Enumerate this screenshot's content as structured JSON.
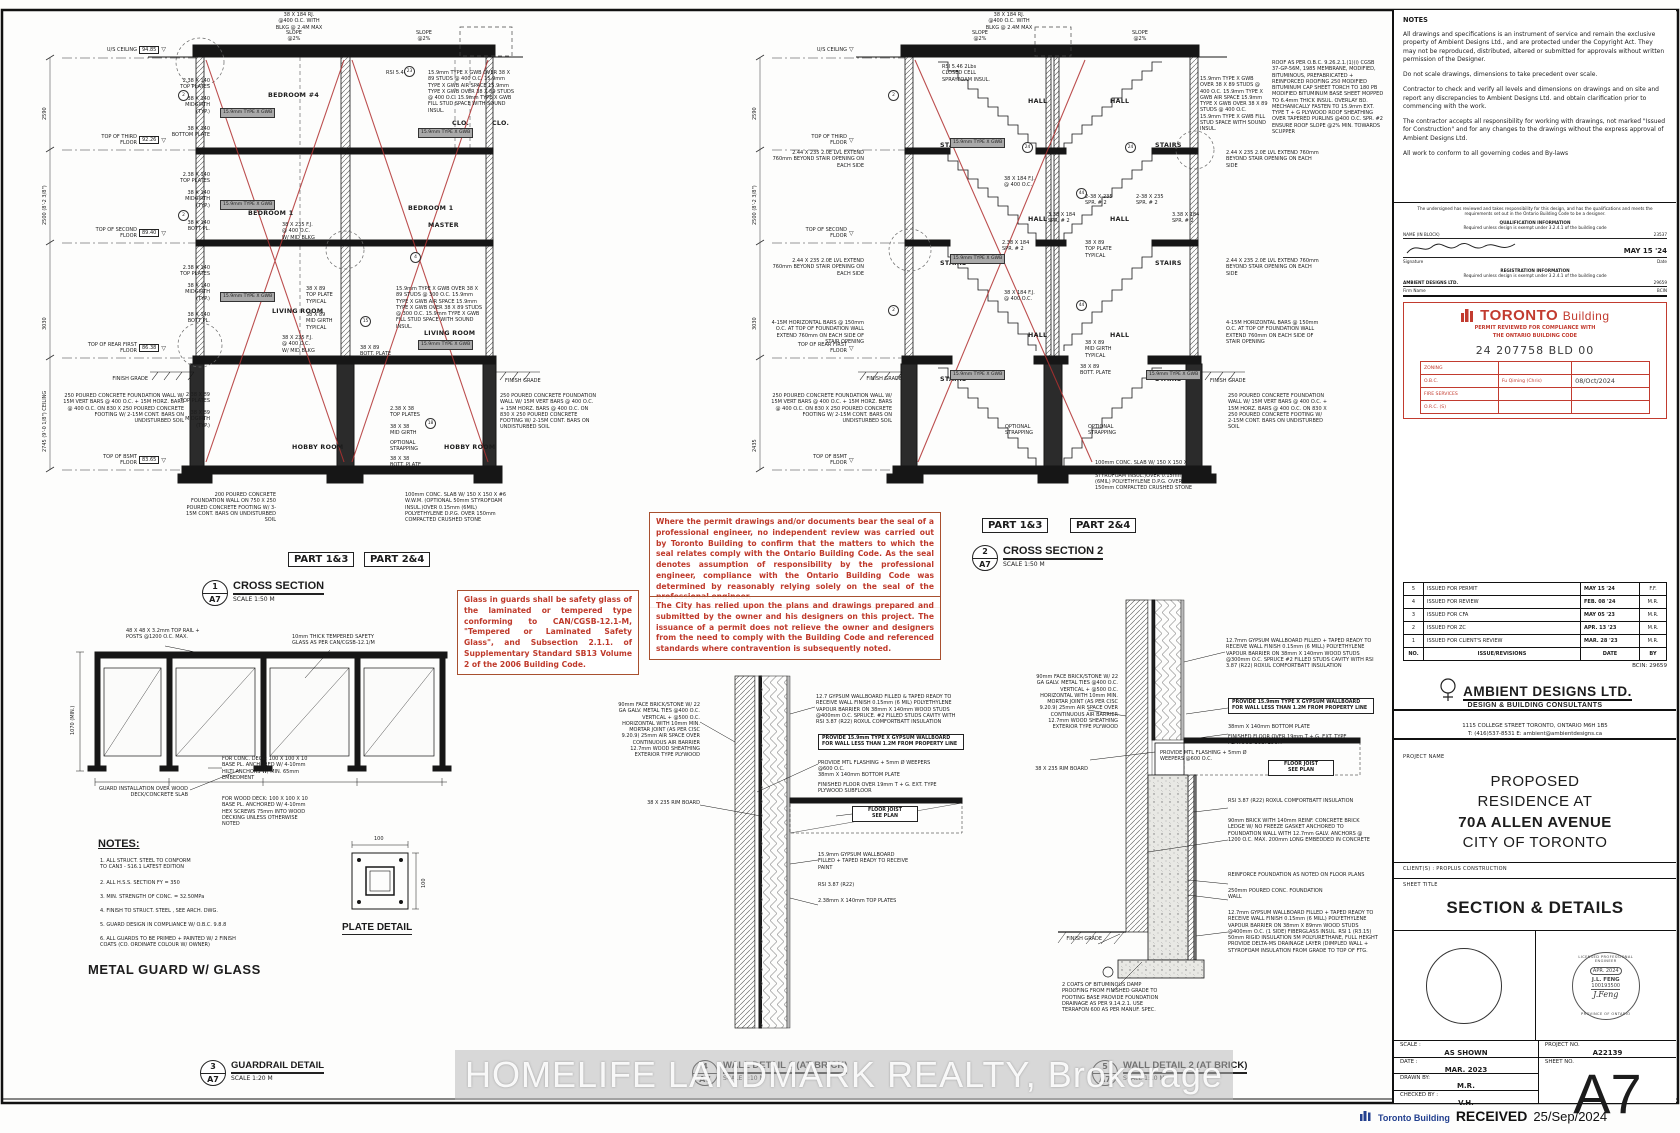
{
  "watermark": "HOMELIFE LANDMARK REALTY, Brokerage",
  "received": {
    "agency": "Toronto Building",
    "label": "RECEIVED",
    "date": "25/Sep/2024"
  },
  "labels": {
    "d1": {
      "num": "1",
      "ref": "A7",
      "title": "CROSS SECTION",
      "scale": "SCALE 1:50 M"
    },
    "d2": {
      "num": "2",
      "ref": "A7",
      "title": "CROSS SECTION 2",
      "scale": "SCALE 1:50 M"
    },
    "d3": {
      "num": "3",
      "ref": "A7",
      "title": "GUARDRAIL DETAIL",
      "scale": "SCALE 1:20 M"
    },
    "d4": {
      "num": "4",
      "ref": "A7",
      "title": "WALL DETAIL 1 (AT BRICK)",
      "scale": "SCALE 1:10 M"
    },
    "d5": {
      "num": "5",
      "ref": "A7",
      "title": "WALL DETAIL 2 (AT BRICK)",
      "scale": "SCALE 1:10 M"
    },
    "part13": "PART 1&3",
    "part24": "PART 2&4"
  },
  "levels": [
    {
      "name": "U/S CEILING",
      "elev": "94.85",
      "tri": "▽"
    },
    {
      "name": "TOP OF THIRD FLOOR",
      "elev": "92.26",
      "tri": "▽"
    },
    {
      "name": "TOP OF SECOND FLOOR",
      "elev": "89.40",
      "tri": "▽"
    },
    {
      "name": "TOP OF REAR FIRST FLOOR",
      "elev": "86.38",
      "tri": "▽"
    },
    {
      "name": "TOP OF BSMT FLOOR",
      "elev": "83.65",
      "tri": "▽"
    }
  ],
  "dims": [
    "2590",
    "2500 (8'-2 3/8\")",
    "3030",
    "2745 (9'-0 1/8\") CEILING",
    "2435"
  ],
  "callouts": [
    "2",
    "4",
    "15",
    "18",
    "23",
    "24",
    "44",
    "46",
    "48",
    "2",
    "24",
    "44"
  ],
  "rooms": {
    "bedroom4": "BEDROOM #4",
    "clo": "CLO.",
    "bedroom1": "BEDROOM 1",
    "master": "MASTER",
    "living": "LIVING ROOM",
    "hobby": "HOBBY ROOM",
    "hall": "HALL",
    "stairs": "STAIRS"
  },
  "ann": {
    "gwb": "15.9mm TYPE X GWB",
    "slope": "SLOPE\n@2%",
    "rj": "38 X 184 RJ.\n@400 O.C. WITH\nBLKG @ 2.4M MAX",
    "rsi546": "RSI 5.46",
    "sprayfoam": "RSI 5.46 2Lbs\nCLOSED CELL\nSPRAYFOAM INSUL.",
    "roof": "ROOF AS PER O.B.C. 9.26.2.1.(1)(i) CGSB 37-GP-56M, 1985 MEMBRANE, MODIFIED, BITUMINOUS, PREFABRICATED + REINFORCED ROOFING 250 MODIFIED BITUMINUM CAP SHEET TORCH TO 180 PB MODIFIED BITUMINUM BASE SHEET MOPPED TO 6.4mm THICK INSUL. OVERLAY BD. MECHANICALLY FASTEN TO 15.9mm EXT. TYPE T + G PLYWOOD ROOF SHEATHING OVER TAPERED PURLINS @400 O.C. SPR. #2 ENSURE ROOF SLOPE @2% MIN. TOWARDS SCUPPER",
    "demising400": "15.9mm TYPE X GWB OVER 38 X 89 STUDS @ 400 O.C. 15.9mm TYPE X GWB AIR SPACE 15.9mm TYPE X GWB OVER 38 X 89 STUDS @ 400 O.C. 15.9mm TYPE X GWB FILL STUD SPACE WITH SOUND INSUL.",
    "demising300": "15.9mm TYPE X GWB OVER 38 X 89 STUDS @ 300 O.C. 15.9mm TYPE X GWB AIR SPACE 15.9mm TYPE X GWB OVER 38 X 89 STUDS @ 300 O.C. 15.9mm TYPE X GWB FILL STUD SPACE WITH SOUND INSUL.",
    "tp140": "2.38 X 140\nTOP PLATES",
    "mid140": "38 X 140\nMIDGIRTH\n(TYP.)",
    "botpl140": "38 X 140\nBOTTOM PLATE",
    "botpl140s": "38 X 140\nBOTT PL.",
    "fj235": "38 X 235 F.J.\n@ 400 O.C.\nW/ MID BLKG",
    "tp89": "2.38 X 89\nTOP PLATES",
    "mid89": "38 X 89\nMIDGIRTH\n(TYP.)",
    "tp38": "2.38 X 38\nTOP PLATES",
    "mg38": "38 X 38\nMID GIRTH",
    "optstrap": "OPTIONAL\nSTRAPPING",
    "bp38": "38 X 38\nBOTT. PLATE",
    "tpTyp": "38 X 89\nTOP PLATE\nTYPICAL",
    "mgTyp": "38 X 89\nMID GIRTH\nTYPICAL",
    "bp89": "38 X 89\nBOTT. PLATE",
    "lvl": "2.44 X 235 2.0E LVL EXTEND 760mm BEYOND STAIR OPENING ON EACH SIDE",
    "fj184": "38 X 184 F.J.\n@ 400 O.C.",
    "spr235": "2-38 X 235\nSPR. # 2",
    "spr184a": "3.38 X 184\nSPR. # 2",
    "spr184b": "2.38 X 184\nSPR. # 2",
    "horizbars": "4-15M HORIZONTAL BARS @ 150mm O.C. AT TOP OF FOUNDATION WALL EXTEND 760mm ON EACH SIDE OF STAIR OPENING",
    "found250": "250 POURED CONCRETE FOUNDATION WALL W/ 15M VERT BARS @ 400 O.C. + 15M HORZ. BARS @ 400 O.C. ON 830 X 250 POURED CONCRETE FOOTING W/ 2-15M CONT. BARS ON UNDISTURBED SOIL",
    "found200": "200 POURED CONCRETE FOUNDATION WALL ON 750 X 250 POURED CONCRETE FOOTING W/ 3-15M CONT. BARS ON UNDISTURBED SOIL",
    "slab": "100mm CONC. SLAB W/ 150 X 150 X #6 W.W.M. (OPTIONAL 50mm STYROFOAM INSUL.)OVER 0.15mm (6MIL) POLYETHYLENE D.P.G. OVER 150mm COMPACTED CRUSHED STONE",
    "grade": "FINISH GRADE"
  },
  "red_notes": {
    "glass": "Glass in guards shall be safety glass of the laminated or tempered type conforming to CAN/CGSB-12.1-M, \"Tempered or Laminated Safety Glass\", and Subsection 2.1.1. of Supplementary Standard SB13 Volume 2 of the 2006 Building Code.",
    "seal": "Where the permit drawings and/or documents bear the seal of a professional engineer, no independent review was carried out by Toronto Building to confirm that the matters to which the seal relates comply with the Ontario Building Code. As the seal denotes assumption of responsibility by the professional engineer, compliance with the Ontario Building Code was determined by reasonably relying solely on the seal of the professional engineer.",
    "city": "The City has relied upon the plans and drawings prepared and submitted by the owner and his designers on this project. The issuance of a permit does not relieve the owner and designers from the need to comply with the Building Code and referenced standards where contravention is subsequently noted."
  },
  "guard": {
    "toprail": "48 X 48 X 3.2mm TOP RAIL + POSTS @1200 O.C. MAX.",
    "glass": "10mm THICK TEMPERED SAFETY GLASS AS PER CAN/CGSB-12.1/M",
    "install": "GUARD INSTALLATION OVER WOOD DECK/CONCRETE SLAB",
    "concdeck": "FOR CONC. DECK: 100 X 100 X 10 BASE PL. ANCHORED W/ 4-10mm HILTI ANCHORS W/ MIN. 65mm EMBEDMENT",
    "wooddeck": "FOR WOOD DECK: 100 X 100 X 10 BASE PL. ANCHORED W/ 4-10mm HEX SCREWS 75mm INTO WOOD DECKING UNLESS OTHERWISE NOTED",
    "height": "1070 (MIN.)",
    "heading": "METAL GUARD W/ GLASS",
    "plate_label": "PLATE DETAIL",
    "plate_dim": "100",
    "notes_title": "NOTES:",
    "notes": [
      "1.   ALL STRUCT. STEEL TO CONFORM\n      TO CAN3 - S16.1 LATEST EDITION",
      "2.   ALL H.S.S. SECTION FY = 350",
      "3.   MIN. STRENGTH OF CONC. = 32.50MPa",
      "4.   FINISH TO STRUCT. STEEL , SEE ARCH. DWG.",
      "5.   GUARD DESIGN IN COMPLIANCE W/ O.B.C. 9.8.8",
      "6.   ALL GUARDS TO BE PRIMED + PAINTED W/ 2 FINISH\n      COATS (CO. ORDINATE COLOUR W/ OWNER)"
    ]
  },
  "d45": {
    "brick90": "90mm FACE BRICK/STONE W/ 22 GA GALV. METAL TIES @400 O.C. VERTICAL + @500 O.C. HORIZONTAL WITH 10mm MIN. MORTAR JOINT (AS PER CISC 9.20.9) 25mm AIR SPACE OVER CONTINUOUS AIR BARRIER 12.7mm WOOD SHEATHING EXTERIOR TYPE PLYWOOD",
    "gyp140": "12.7 GYPSUM WALLBOARD FILLED & TAPED READY TO RECEIVE WALL FINISH 0.15mm (6 MIL) POLYETHYLENE VAPOUR BARRIER ON 38mm X 140mm WOOD STUDS @400mm O.C. SPRUCE. #2 FILLED STUDS CAVITY WITH RSI 3.87 (R22) ROXUL COMFORTBATT INSULATION",
    "gyp89": "12.7mm GYPSUM WALLBOARD FILLED + TAPED READY TO RECEIVE WALL FINISH 0.15mm (6 MILL) POLYETHYLENE VAPOUR BARRIER ON 38mm X 140mm WOOD STUDS @300mm O.C. SPRUCE #2 FILLED STUDS CAVITY WITH RSI 3.87 (R22) ROXUL COMFORTBATT INSULATION",
    "provide": "PROVIDE 15.9mm TYPE X GYPSUM WALLBOARD FOR WALL LESS THAN 1.2M FROM PROPERTY LINE",
    "bottomplate": "38mm X 140mm BOTTOM PLATE",
    "topplates": "2.38mm X 140mm TOP PLATES",
    "finfloor": "FINISHED FLOOR OVER 19mm T + G. EXT. TYPE PLYWOOD SUBFLOOR",
    "floorjoist": "FLOOR JOIST\nSEE PLAN",
    "rim": "38 X 235 RIM BOARD",
    "flashing": "PROVIDE MTL FLASHING + 5mm Ø WEEPERS @600 O.C.",
    "gwbpaint": "15.9mm GYPSUM WALLBOARD FILLED + TAPED READY TO RECEIVE PAINT",
    "rsi": "RSI 3.87 (R22)",
    "rsiroxul": "RSI 3.87 (R22) ROXUL COMFORTBATT INSULATION",
    "brickledge": "90mm BRICK WITH 140mm REINF. CONCRETE BRICK LEDGE W/ NO FREEZE GASKET ANCHORED TO FOUNDATION WALL WITH 12.7mm GALV. ANCHORS @ 1200 O.C. MAX. 200mm LONG EMBEDDED IN CONCRETE",
    "reinforce": "REINFORCE FOUNDATION AS NOTED ON FLOOR PLANS",
    "foundwall": "250mm POURED CONC. FOUNDATION WALL",
    "bsmtwall": "12.7mm GYPSUM WALLBOARD FILLED + TAPED READY TO RECEIVE WALL FINISH 0.15mm (6 MILL) POLYETHYLENE VAPOUR BARRIER ON 38mm X 89mm WOOD STUDS @400mm O.C. (1 SIDE) FIBERGLASS INSUL. RSI 1 (R3.15) 50mm RIGID INSULATION 5M POLYURETHANE, FULL HEIGHT PROVIDE DELTA-MS DRAINAGE LAYER (DIMPLED WALL + STYROFOAM INSULATION FROM GRADE TO TOP OF FTG.",
    "dampproof": "2 COATS OF BITUMINOUS DAMP PROOFING FROM FINISHED GRADE TO FOOTING BASE PROVIDE FOUNDATION DRAINAGE AS PER 9.14.2.1. USE TERRAFON 600 AS PER MANUF. SPEC."
  },
  "titleblock": {
    "notes_title": "NOTES",
    "notes": [
      "All drawings and specifications is an instrument of service and remain the exclusive property of Ambient Designs Ltd., and are protected under the Copyright Act.  They may not be reproduced, distributed, altered or submitted for approvals without written permission of the Designer.",
      "Do not scale drawings, dimensions to take precedent over scale.",
      "Contractor to check and verify all levels and dimensions on drawings and on site and report any discrepancies to Ambient Designs Ltd. and obtain clarification prior to commencing with the work.",
      "The contractor accepts all responsibility for working with drawings, not marked \"Issued for Construction\" and for any changes to the drawings without the express approval of Ambient Designs Ltd.",
      "All work to conform to all governing codes and By-laws"
    ],
    "decl": {
      "text": "The undersigned has reviewed and takes responsibility for this design, and has the qualifications and meets the requirements set out in the Ontario Building Code to be a designer.",
      "qual_title": "QUALIFICATION INFORMATION",
      "qual_sub": "Required unless design is exempt under 3.2.4.1 of the building code",
      "name_label": "NAME (IN BLOCK)",
      "name_bcin": "23537",
      "sig_label": "Signature",
      "date_label": "Date",
      "date": "MAY 15 '24",
      "reg_title": "REGISTRATION INFORMATION",
      "reg_sub": "Required unless design is exempt under 3.2.4.1 of the building code",
      "firm": "AMBIENT DESIGNS LTD.",
      "firm_bcin": "29659",
      "firm_label": "Firm Name",
      "bcin_label": "BCIN"
    },
    "stamp": {
      "brand_bold": "TORONTO",
      "brand_light": "Building",
      "line1": "PERMIT REVIEWED FOR COMPLIANCE WITH",
      "line2": "THE ONTARIO BUILDING CODE",
      "permit_no": "24 207758 BLD 00",
      "rows": [
        [
          "ZONING",
          "",
          ""
        ],
        [
          "O.B.C.",
          "Fu Qiming (Chris)",
          "08/Oct/2024"
        ],
        [
          "FIRE SERVICES",
          "",
          ""
        ],
        [
          "O.R.C. (S)",
          "",
          ""
        ]
      ]
    },
    "revisions": {
      "rows": [
        [
          "5",
          "ISSUED FOR PERMIT",
          "MAY 15 '24",
          "F.F."
        ],
        [
          "4",
          "ISSUED FOR REVIEW",
          "FEB. 08 '24",
          "M.R."
        ],
        [
          "3",
          "ISSUED FOR CFA",
          "MAY 05 '23",
          "M.R."
        ],
        [
          "2",
          "ISSUED FOR ZC",
          "APR. 13 '23",
          "M.R."
        ],
        [
          "1",
          "ISSUED FOR CLIENT'S REVIEW",
          "MAR. 28 '23",
          "M.R."
        ],
        [
          "NO.",
          "ISSUE/REVISIONS",
          "DATE",
          "BY"
        ]
      ]
    },
    "bcin": "BCIN: 29659",
    "firm": {
      "name": "AMBIENT DESIGNS LTD.",
      "tag": "DESIGN & BUILDING CONSULTANTS",
      "addr1": "1115 COLLEGE STREET  TORONTO, ONTARIO  M6H 1B5",
      "addr2": "T: (416)537-8531     E:  ambient@ambientdesigns.ca"
    },
    "project_label": "PROJECT NAME",
    "project": [
      "PROPOSED",
      "RESIDENCE AT",
      "70A ALLEN AVENUE",
      "CITY OF TORONTO"
    ],
    "client": "CLIENT(S) : PROPLUS CONSTRUCTION",
    "sheet_title_label": "SHEET  TITLE",
    "sheet_title": "SECTION & DETAILS",
    "pe_seal": {
      "ring_top": "LICENSED PROFESSIONAL ENGINEER",
      "date": "APR. 2024",
      "name": "J.L. FENG",
      "number": "100193500",
      "sig": "J.Feng",
      "ring_bottom": "PROVINCE OF ONTARIO"
    },
    "fields": {
      "scale_label": "SCALE :",
      "scale": "AS SHOWN",
      "date_label": "DATE :",
      "date": "MAR. 2023",
      "drawn_label": "DRAWN BY:",
      "drawn": "M.R.",
      "checked_label": "CHECKED BY :",
      "checked": "V.H.",
      "projno_label": "PROJECT  NO.",
      "projno": "A22139",
      "sheetno_label": "SHEET  NO.",
      "sheetno": "A7"
    }
  }
}
